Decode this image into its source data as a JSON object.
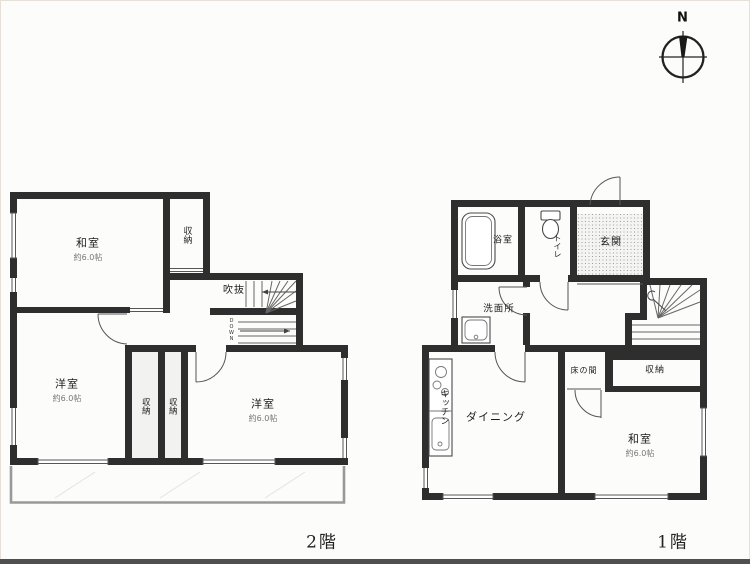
{
  "compass": {
    "label": "N"
  },
  "floor2": {
    "title": "2階",
    "washitsu": {
      "name": "和室",
      "size": "約6.0帖"
    },
    "closet_top": {
      "name": "収納"
    },
    "fukinuke": {
      "name": "吹抜"
    },
    "stair_direction": {
      "name": "DOWN"
    },
    "youshitsu_left": {
      "name": "洋室",
      "size": "約6.0帖"
    },
    "closet_a": {
      "name": "収納"
    },
    "closet_b": {
      "name": "収納"
    },
    "youshitsu_right": {
      "name": "洋室",
      "size": "約6.0帖"
    }
  },
  "floor1": {
    "title": "1階",
    "bathroom": {
      "name": "浴室"
    },
    "toilet": {
      "name": "トイレ"
    },
    "entrance": {
      "name": "玄関"
    },
    "washroom": {
      "name": "洗面所"
    },
    "kitchen": {
      "name": "キッチン"
    },
    "dining": {
      "name": "ダイニング"
    },
    "tokonoma": {
      "name": "床の間"
    },
    "closet": {
      "name": "収納"
    },
    "washitsu": {
      "name": "和室",
      "size": "約6.0帖"
    }
  },
  "colors": {
    "wall": "#2e2e2e",
    "thin_line": "#555555",
    "balcony": "#999999",
    "size_text": "#777777",
    "bottom_strip": "#4f4f4f"
  }
}
